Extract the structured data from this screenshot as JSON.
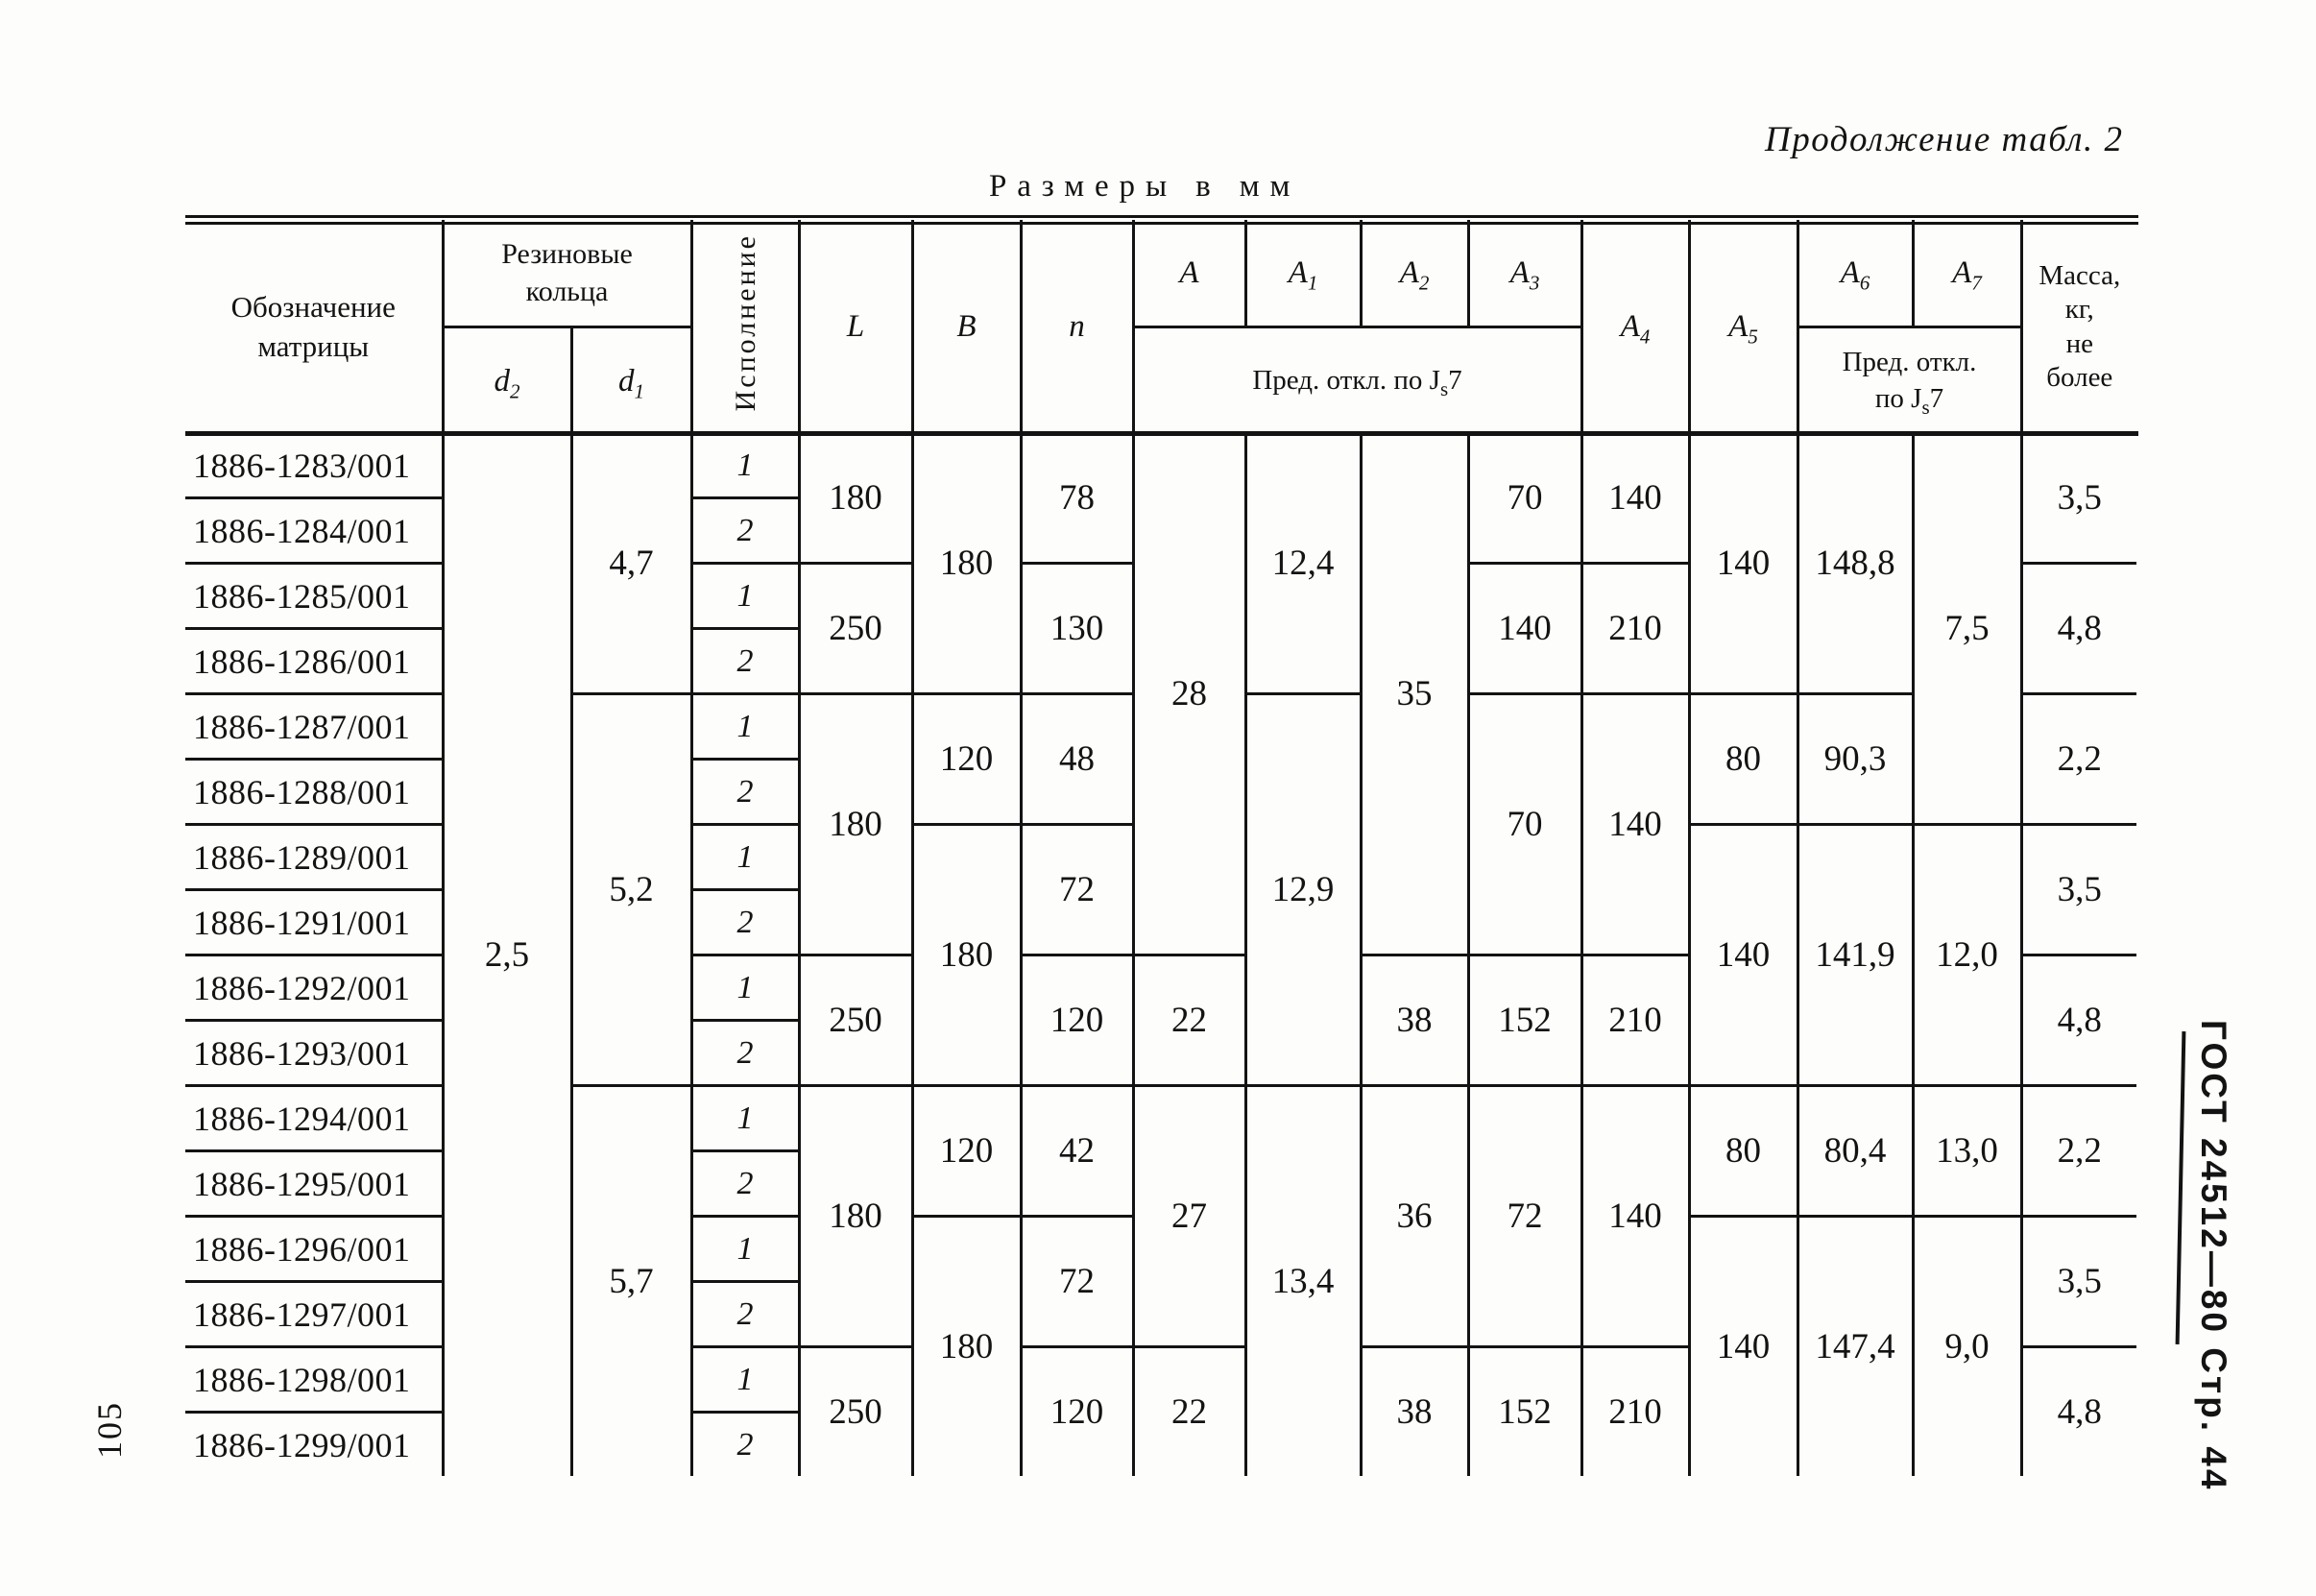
{
  "page": {
    "continuation_label": "Продолжение табл. 2",
    "units_label": "Размеры в мм",
    "page_number": "105",
    "side_label": "ГОСТ 24512—80  Стр. 44"
  },
  "table": {
    "header": {
      "designation": "Обозначение\nматрицы",
      "rubber_rings": "Резиновые\nкольца",
      "d_base": "d",
      "d2_sub": "2",
      "d1_sub": "1",
      "version": "Исполнение",
      "L": "L",
      "B": "B",
      "n": "n",
      "A_base": "A",
      "A1_sub": "1",
      "A2_sub": "2",
      "A3_sub": "3",
      "A4_sub": "4",
      "A5_sub": "5",
      "A6_sub": "6",
      "A7_sub": "7",
      "tolerance_prefix": "Пред. откл. по J",
      "tolerance_sub": "s",
      "tolerance_suffix": "7",
      "tolerance2_line1": "Пред. откл.",
      "tolerance2_prefix": "по J",
      "mass": "Масса,\nкг,\nне\nболее"
    },
    "rows": [
      {
        "designation": "1886-1283/001",
        "version": "1"
      },
      {
        "designation": "1886-1284/001",
        "version": "2"
      },
      {
        "designation": "1886-1285/001",
        "version": "1"
      },
      {
        "designation": "1886-1286/001",
        "version": "2"
      },
      {
        "designation": "1886-1287/001",
        "version": "1"
      },
      {
        "designation": "1886-1288/001",
        "version": "2"
      },
      {
        "designation": "1886-1289/001",
        "version": "1"
      },
      {
        "designation": "1886-1291/001",
        "version": "2"
      },
      {
        "designation": "1886-1292/001",
        "version": "1"
      },
      {
        "designation": "1886-1293/001",
        "version": "2"
      },
      {
        "designation": "1886-1294/001",
        "version": "1"
      },
      {
        "designation": "1886-1295/001",
        "version": "2"
      },
      {
        "designation": "1886-1296/001",
        "version": "1"
      },
      {
        "designation": "1886-1297/001",
        "version": "2"
      },
      {
        "designation": "1886-1298/001",
        "version": "1"
      },
      {
        "designation": "1886-1299/001",
        "version": "2"
      }
    ],
    "columns": {
      "d2": [
        {
          "from": 1,
          "to": 16,
          "value": "2,5"
        }
      ],
      "d1": [
        {
          "from": 1,
          "to": 4,
          "value": "4,7"
        },
        {
          "from": 5,
          "to": 10,
          "value": "5,2"
        },
        {
          "from": 11,
          "to": 16,
          "value": "5,7"
        }
      ],
      "L": [
        {
          "from": 1,
          "to": 2,
          "value": "180"
        },
        {
          "from": 3,
          "to": 4,
          "value": "250"
        },
        {
          "from": 5,
          "to": 8,
          "value": "180"
        },
        {
          "from": 9,
          "to": 10,
          "value": "250"
        },
        {
          "from": 11,
          "to": 14,
          "value": "180"
        },
        {
          "from": 15,
          "to": 16,
          "value": "250"
        }
      ],
      "B": [
        {
          "from": 1,
          "to": 4,
          "value": "180"
        },
        {
          "from": 5,
          "to": 6,
          "value": "120"
        },
        {
          "from": 7,
          "to": 10,
          "value": "180"
        },
        {
          "from": 11,
          "to": 12,
          "value": "120"
        },
        {
          "from": 13,
          "to": 16,
          "value": "180"
        }
      ],
      "n": [
        {
          "from": 1,
          "to": 2,
          "value": "78"
        },
        {
          "from": 3,
          "to": 4,
          "value": "130"
        },
        {
          "from": 5,
          "to": 6,
          "value": "48"
        },
        {
          "from": 7,
          "to": 8,
          "value": "72"
        },
        {
          "from": 9,
          "to": 10,
          "value": "120"
        },
        {
          "from": 11,
          "to": 12,
          "value": "42"
        },
        {
          "from": 13,
          "to": 14,
          "value": "72"
        },
        {
          "from": 15,
          "to": 16,
          "value": "120"
        }
      ],
      "A": [
        {
          "from": 1,
          "to": 8,
          "value": "28"
        },
        {
          "from": 9,
          "to": 10,
          "value": "22"
        },
        {
          "from": 11,
          "to": 14,
          "value": "27"
        },
        {
          "from": 15,
          "to": 16,
          "value": "22"
        }
      ],
      "A1": [
        {
          "from": 1,
          "to": 4,
          "value": "12,4"
        },
        {
          "from": 5,
          "to": 10,
          "value": "12,9"
        },
        {
          "from": 11,
          "to": 16,
          "value": "13,4"
        }
      ],
      "A2": [
        {
          "from": 1,
          "to": 8,
          "value": "35"
        },
        {
          "from": 9,
          "to": 10,
          "value": "38"
        },
        {
          "from": 11,
          "to": 14,
          "value": "36"
        },
        {
          "from": 15,
          "to": 16,
          "value": "38"
        }
      ],
      "A3": [
        {
          "from": 1,
          "to": 2,
          "value": "70"
        },
        {
          "from": 3,
          "to": 4,
          "value": "140"
        },
        {
          "from": 5,
          "to": 8,
          "value": "70"
        },
        {
          "from": 9,
          "to": 10,
          "value": "152"
        },
        {
          "from": 11,
          "to": 14,
          "value": "72"
        },
        {
          "from": 15,
          "to": 16,
          "value": "152"
        }
      ],
      "A4": [
        {
          "from": 1,
          "to": 2,
          "value": "140"
        },
        {
          "from": 3,
          "to": 4,
          "value": "210"
        },
        {
          "from": 5,
          "to": 8,
          "value": "140"
        },
        {
          "from": 9,
          "to": 10,
          "value": "210"
        },
        {
          "from": 11,
          "to": 14,
          "value": "140"
        },
        {
          "from": 15,
          "to": 16,
          "value": "210"
        }
      ],
      "A5": [
        {
          "from": 1,
          "to": 4,
          "value": "140"
        },
        {
          "from": 5,
          "to": 6,
          "value": "80"
        },
        {
          "from": 7,
          "to": 10,
          "value": "140"
        },
        {
          "from": 11,
          "to": 12,
          "value": "80"
        },
        {
          "from": 13,
          "to": 16,
          "value": "140"
        }
      ],
      "A6": [
        {
          "from": 1,
          "to": 4,
          "value": "148,8"
        },
        {
          "from": 5,
          "to": 6,
          "value": "90,3"
        },
        {
          "from": 7,
          "to": 10,
          "value": "141,9"
        },
        {
          "from": 11,
          "to": 12,
          "value": "80,4"
        },
        {
          "from": 13,
          "to": 16,
          "value": "147,4"
        }
      ],
      "A7": [
        {
          "from": 1,
          "to": 6,
          "value": "7,5"
        },
        {
          "from": 7,
          "to": 10,
          "value": "12,0"
        },
        {
          "from": 11,
          "to": 12,
          "value": "13,0"
        },
        {
          "from": 13,
          "to": 16,
          "value": "9,0"
        }
      ],
      "mass": [
        {
          "from": 1,
          "to": 2,
          "value": "3,5"
        },
        {
          "from": 3,
          "to": 4,
          "value": "4,8"
        },
        {
          "from": 5,
          "to": 6,
          "value": "2,2"
        },
        {
          "from": 7,
          "to": 8,
          "value": "3,5"
        },
        {
          "from": 9,
          "to": 10,
          "value": "4,8"
        },
        {
          "from": 11,
          "to": 12,
          "value": "2,2"
        },
        {
          "from": 13,
          "to": 14,
          "value": "3,5"
        },
        {
          "from": 15,
          "to": 16,
          "value": "4,8"
        }
      ]
    }
  }
}
